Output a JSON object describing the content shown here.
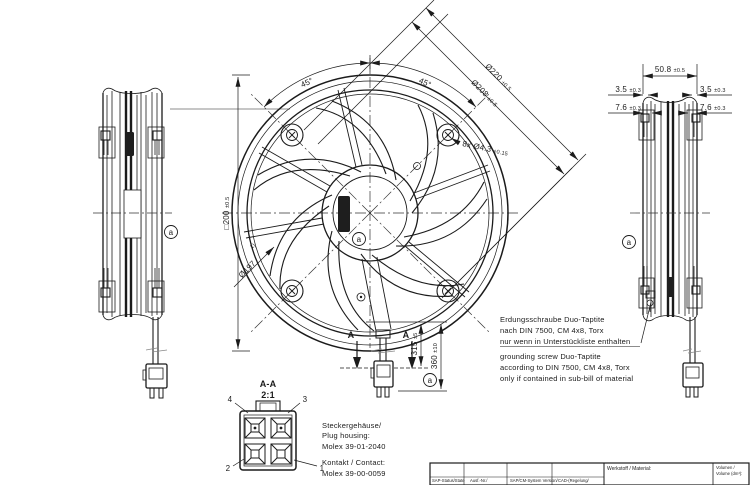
{
  "dims": {
    "dia220": {
      "v": "Ø220",
      "t": "±0.5"
    },
    "dia208": {
      "v": "Ø208",
      "t": "±0.5"
    },
    "holes": {
      "v": "8x Ø4.3",
      "t": "±0.15"
    },
    "square": {
      "v": "□200",
      "t": "±0.5"
    },
    "dia197": {
      "v": "Ø197",
      "ref": "1)"
    },
    "angle_l": "45°",
    "angle_r": "45°",
    "width": {
      "v": "50.8",
      "t": "±0.5"
    },
    "flange_l": {
      "v": "3.5",
      "t": "±0.3"
    },
    "flange_r": {
      "v": "3.5",
      "t": "±0.3"
    },
    "boss_l": {
      "v": "7.6",
      "t": "±0.3"
    },
    "boss_r": {
      "v": "7.6",
      "t": "±0.3"
    },
    "cable315": {
      "v": "315",
      "t": "±5"
    },
    "cable360": {
      "v": "360",
      "t": "±10"
    }
  },
  "section": {
    "mark_l": "A",
    "mark_r": "A",
    "title": "A-A",
    "scale": "2:1",
    "pin1": "1",
    "pin2": "2",
    "pin3": "3",
    "pin4": "4"
  },
  "balloons": {
    "front": "a",
    "left": "a",
    "right": "a",
    "cable": "a"
  },
  "notes": {
    "de1": "Erdungsschraube Duo-Taptite",
    "de2": "nach DIN 7500, CM 4x8, Torx",
    "de3": "nur wenn in Unterstückliste enthalten",
    "en1": "grounding screw Duo-Taptite",
    "en2": "according to DIN 7500, CM 4x8, Torx",
    "en3": "only if contained in sub-bill of material",
    "plug1": "Steckergehäuse/",
    "plug2": "Plug housing:",
    "plug3": "Molex 39-01-2040",
    "contact1": "Kontakt / Contact:",
    "contact2": "Molex 39-00-0059"
  },
  "title_block": {
    "sap_status": "SAP-Status/State",
    "ausf_nr": "Ausf.-Nr./",
    "sap_cm": "SAP/CM-System Version/",
    "cad": "CAD-(Regelung/",
    "material": "Werkstoff / Material:",
    "volume1": "Volumen /",
    "volume2": "Volume (dm³):"
  },
  "colors": {
    "line": "#1b1b1b",
    "background": "#ffffff"
  }
}
